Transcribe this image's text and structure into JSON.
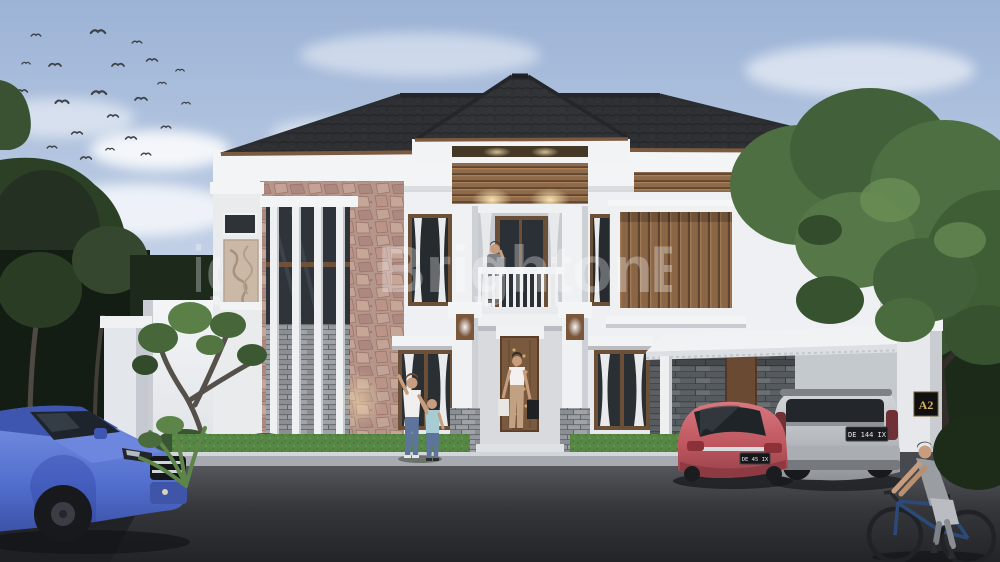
{
  "image": {
    "type": "3d-architectural-rendering",
    "subject": "Modern two-storey tropical house with stone accent wall, central balcony portico, carport with two cars, front lawn with residents, blue SUV on street and a passing cyclist",
    "watermark_text": "Brighton",
    "house_plaque": "A2",
    "plates": {
      "red_car": "DE 45 IX",
      "silver_car": "DE 144 IX"
    },
    "palette": {
      "sky_top": "#9cb3d6",
      "sky_bottom": "#e7ecf3",
      "roof": "#36383c",
      "wall_white": "#eef0f3",
      "stone_rose": "#c2a094",
      "stone_gray": "#969a9e",
      "wood": "#8a6647",
      "grass": "#568744",
      "road": "#3c3d41",
      "car_blue": "#5470cf",
      "car_red": "#bc545c",
      "car_silver": "#b6b9bd",
      "plaque_gold": "#d9b35c"
    }
  }
}
